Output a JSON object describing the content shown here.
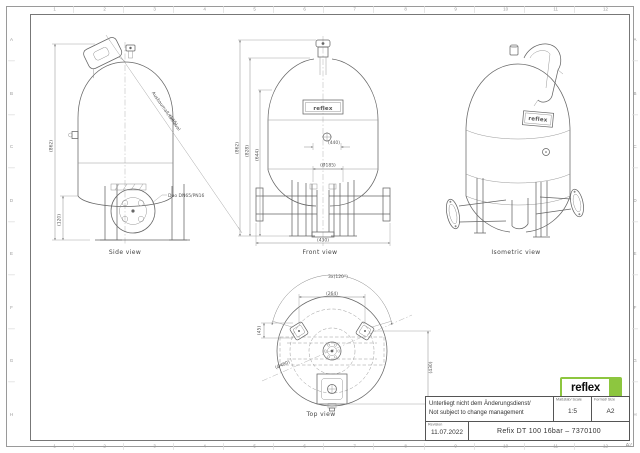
{
  "sheet": {
    "corner_label": "A2",
    "grid_columns": [
      "1",
      "2",
      "3",
      "4",
      "5",
      "6",
      "7",
      "8",
      "9",
      "10",
      "11",
      "12"
    ],
    "grid_rows": [
      "A",
      "B",
      "C",
      "D",
      "E",
      "F",
      "G",
      "H"
    ]
  },
  "brand": {
    "logo_text": "reflex",
    "logo_green": "#8dc63f"
  },
  "title_block": {
    "note_line1": "Unterliegt nicht dem Änderungsdienst/",
    "note_line2": "Not subject to change management",
    "scale_label": "Maßstab/ Scale",
    "scale_value": "1:5",
    "format_label": "Format/ Size",
    "format_value": "A2",
    "revision_label": "Revision",
    "revision_date": "11.07.2022",
    "drawing_title": "Refix DT 100 16bar – 7370100"
  },
  "views": {
    "side": {
      "label": "Side view",
      "dim_height": "(862)",
      "dim_base": "(120)",
      "connection_label": "Duo DN65/PN16",
      "diag_label1": "Ausbaumaß/removal",
      "diag_label2": "(565)",
      "nameplate": "reflex"
    },
    "front": {
      "label": "Front view",
      "dim_total_height": "(862)",
      "dim_height2": "(828)",
      "dim_height3": "(644)",
      "dim_mid": "(440)",
      "dim_flange": "(Ø185)",
      "dim_width": "(430)",
      "nameplate": "reflex"
    },
    "iso": {
      "label": "Isometric view",
      "nameplate": "reflex"
    },
    "top": {
      "label": "Top view",
      "dim_angle": "3x(120°)",
      "dim_feet": "(264)",
      "dim_foot": "(45)",
      "dim_depth": "(430)",
      "dim_diameter": "(Ø480)"
    }
  }
}
